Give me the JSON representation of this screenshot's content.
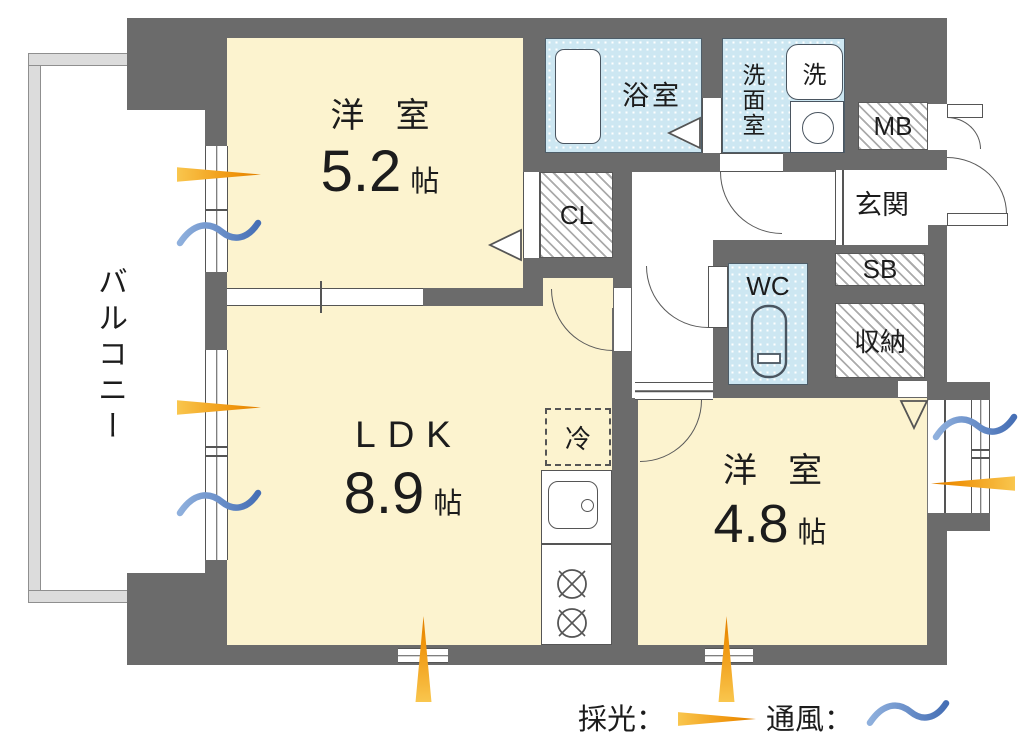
{
  "rooms": {
    "bedroom_top": {
      "name": "洋 室",
      "size": "5.2",
      "unit": "帖"
    },
    "ldk": {
      "name": "LDK",
      "size": "8.9",
      "unit": "帖"
    },
    "bedroom_right": {
      "name": "洋 室",
      "size": "4.8",
      "unit": "帖"
    },
    "balcony_label": "バルコニー",
    "bath_label": "浴室",
    "washroom_label": "洗面室",
    "wc_label": "WC",
    "entrance_label": "玄関",
    "closet_label": "CL",
    "meter_box_label": "MB",
    "shoe_box_label": "SB",
    "storage_label": "収納"
  },
  "fixtures": {
    "washer_label": "洗",
    "fridge_label": "冷"
  },
  "legend": {
    "daylight_label": "採光：",
    "ventilation_label": "通風："
  },
  "colors": {
    "wall": "#6b6b6b",
    "room_floor": "#fcf3cf",
    "wet_area": "#cde7f2",
    "daylight_arrow": "#ef930a",
    "ventilation_wave": "#5c8bd0",
    "balcony_railing": "#dcdcdc"
  }
}
